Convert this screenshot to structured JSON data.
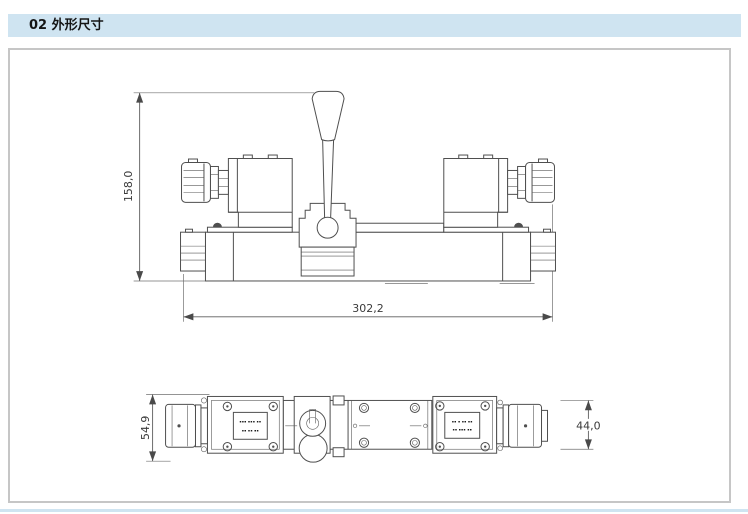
{
  "header": {
    "title": "02 外形尺寸"
  },
  "drawing": {
    "front_view": {
      "dim_height": "158,0",
      "dim_width": "302,2"
    },
    "bottom_view": {
      "dim_overall_height": "54,9",
      "dim_body_height": "44,0",
      "nameplate_left": {
        "line1": "▪▪▪ ▪▪▪ ▪▪",
        "line2": "▪▪ ▪▪ ▪▪"
      },
      "nameplate_right": {
        "line1": "▪▪ ▪ ▪▪ ▪▪",
        "line2": "▪▪ ▪▪▪ ▪▪"
      }
    },
    "colors": {
      "header_bg": "#cfe4f1",
      "box_border": "#c6c6c6",
      "line": "#4f4f4f",
      "dim_text": "#3a3a3a",
      "bottom_strip": "#cfe4f1"
    }
  }
}
